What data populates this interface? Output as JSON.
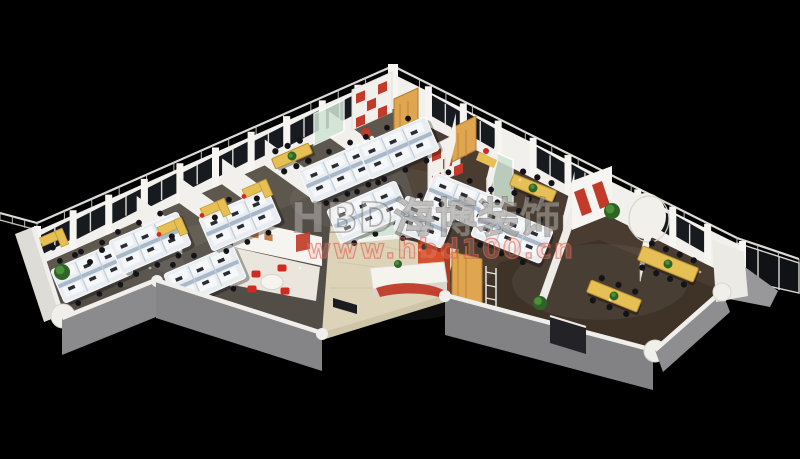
{
  "watermark": {
    "brand": "HBD海博装饰",
    "url": "www.hbd100.cn"
  },
  "palette": {
    "background": "#000000",
    "wall_white": "#f2f0ec",
    "wall_pillar": "#f7f5f1",
    "wall_gray": "#8a898c",
    "wall_gray_light": "#98979a",
    "wall_cap": "#f1efeb",
    "window_glass": "#171a1f",
    "floor_left_wing": "#534d47",
    "floor_office_strip": "#5e574e",
    "floor_right_wing": "#4a3c30",
    "floor_lobby": "#ddd3b8",
    "floor_meeting_room": "#eae6dd",
    "accent_red": "#c23b2a",
    "reception_red": "#d5502c",
    "wood": "#dfa54f",
    "desk_yellow": "#e6bf55",
    "cubicle_base": "#e9edf1",
    "cubicle_desk": "#f5f7f9",
    "partition_blue": "#a9b9c9",
    "partition_line": "#c2cedb",
    "glass_green": "#cfe4d4",
    "plant_green": "#2e6526",
    "plant_green_light": "#4d8f3b",
    "chair_black": "#141418",
    "chair_red": "#cf2b20",
    "railing_white": "#dcdad6",
    "monitor_dark": "#2a2d33"
  }
}
